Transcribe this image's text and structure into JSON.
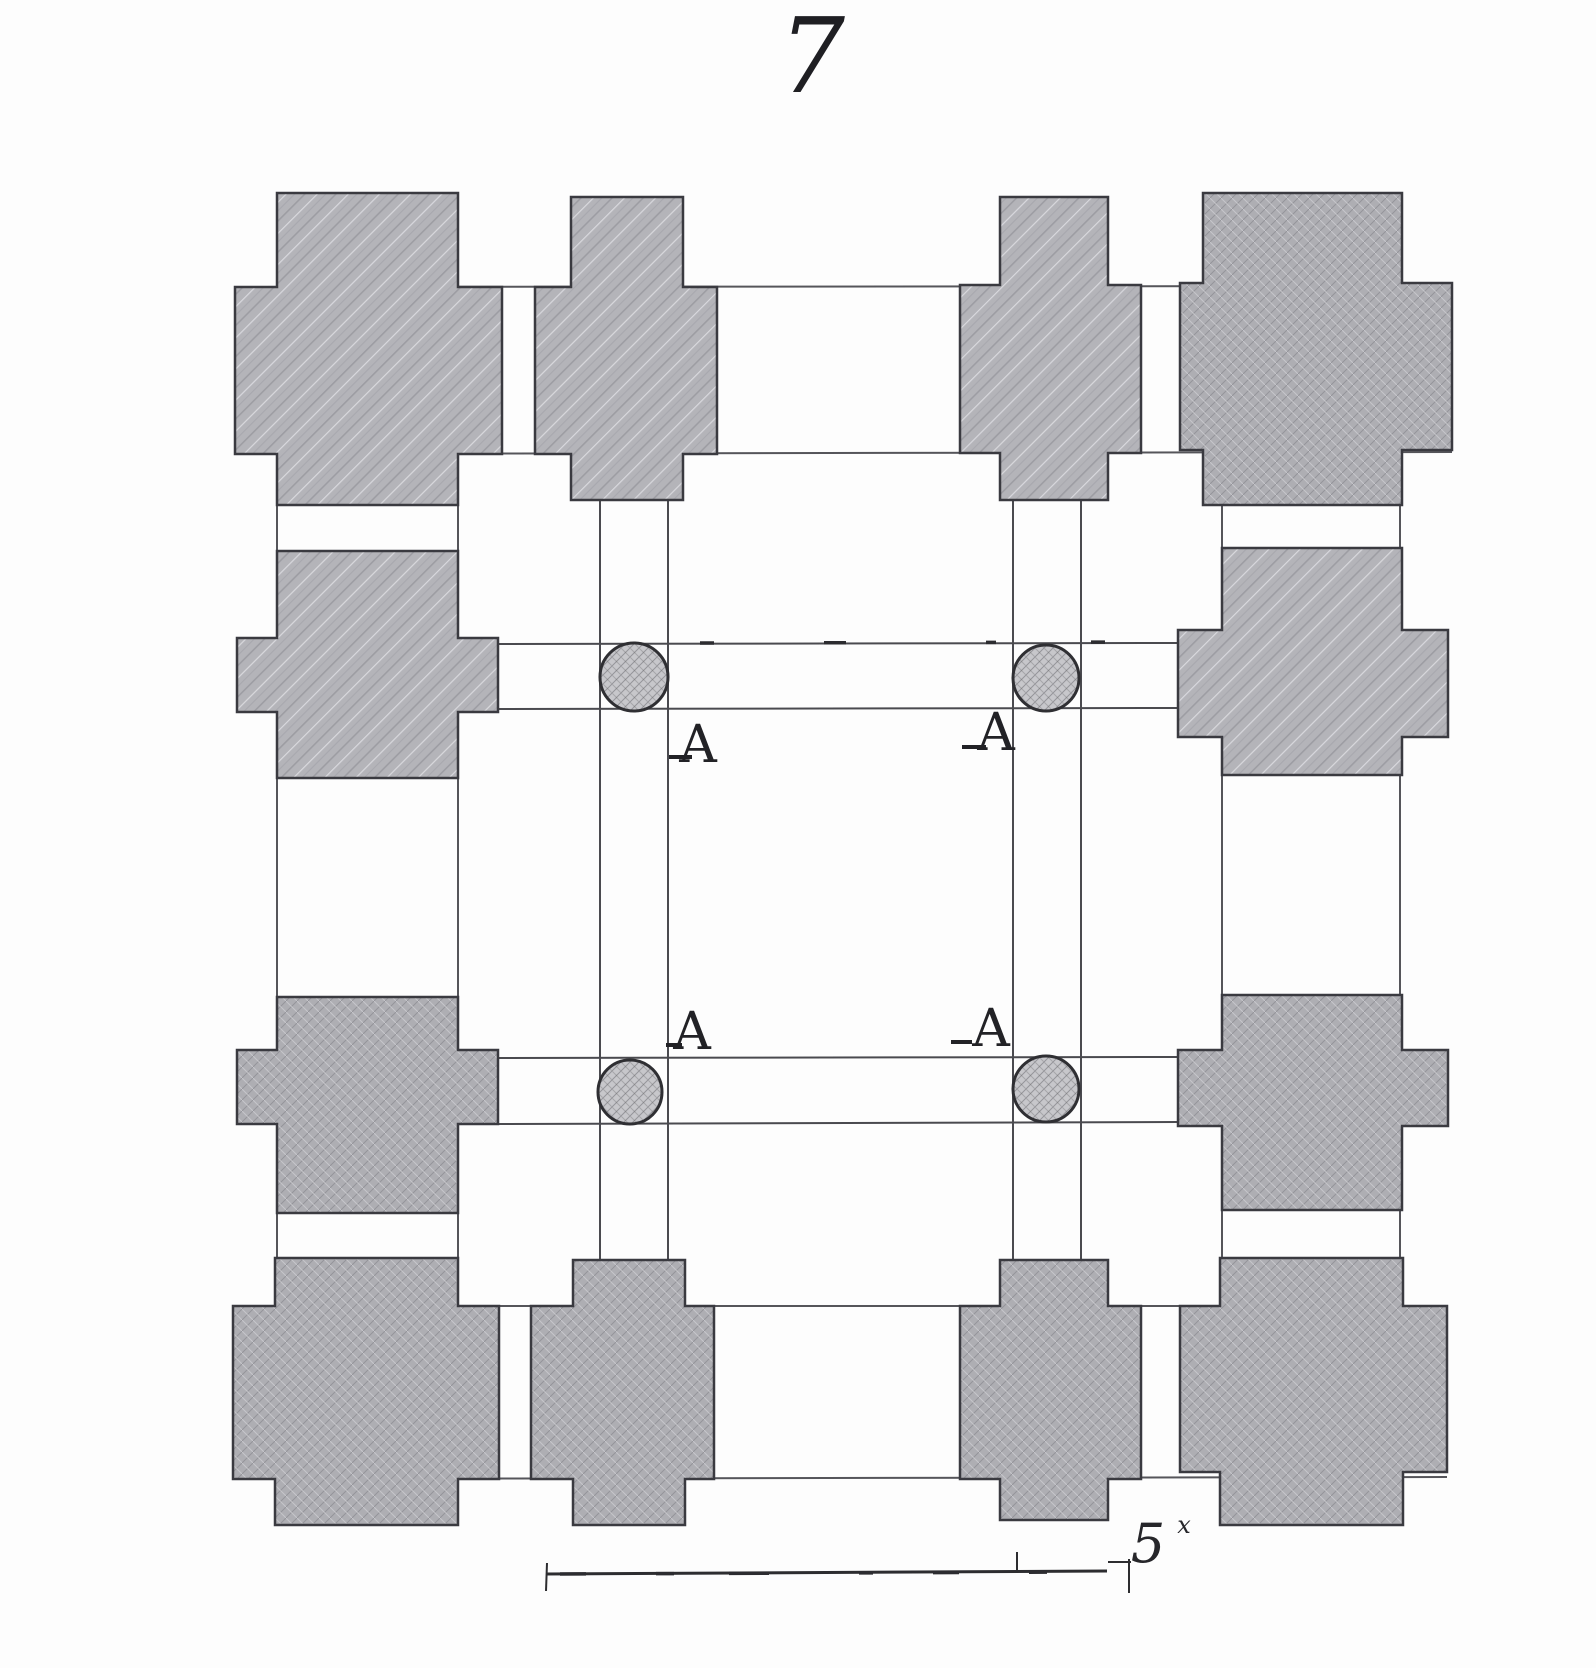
{
  "figure": {
    "number": "7"
  },
  "plan": {
    "kind": "architectural-floor-plan-engraving",
    "pier_count": 12,
    "column_count": 4,
    "column_labels": [
      {
        "text": "A",
        "position": "upper-left"
      },
      {
        "text": "A",
        "position": "upper-right"
      },
      {
        "text": "A",
        "position": "lower-left"
      },
      {
        "text": "A",
        "position": "lower-right"
      }
    ]
  },
  "scale_bar": {
    "value": "5",
    "superscript_mark": "x"
  },
  "colors": {
    "background": "#fdfdfd",
    "pier_fill_streaked": "#b4b4b9",
    "pier_fill_crosshatch": "#aeaeb3",
    "column_fill": "#c7c7cb",
    "pier_outline": "#3a3a40",
    "wall_line": "#55555a",
    "ink": "#1f1f23"
  }
}
